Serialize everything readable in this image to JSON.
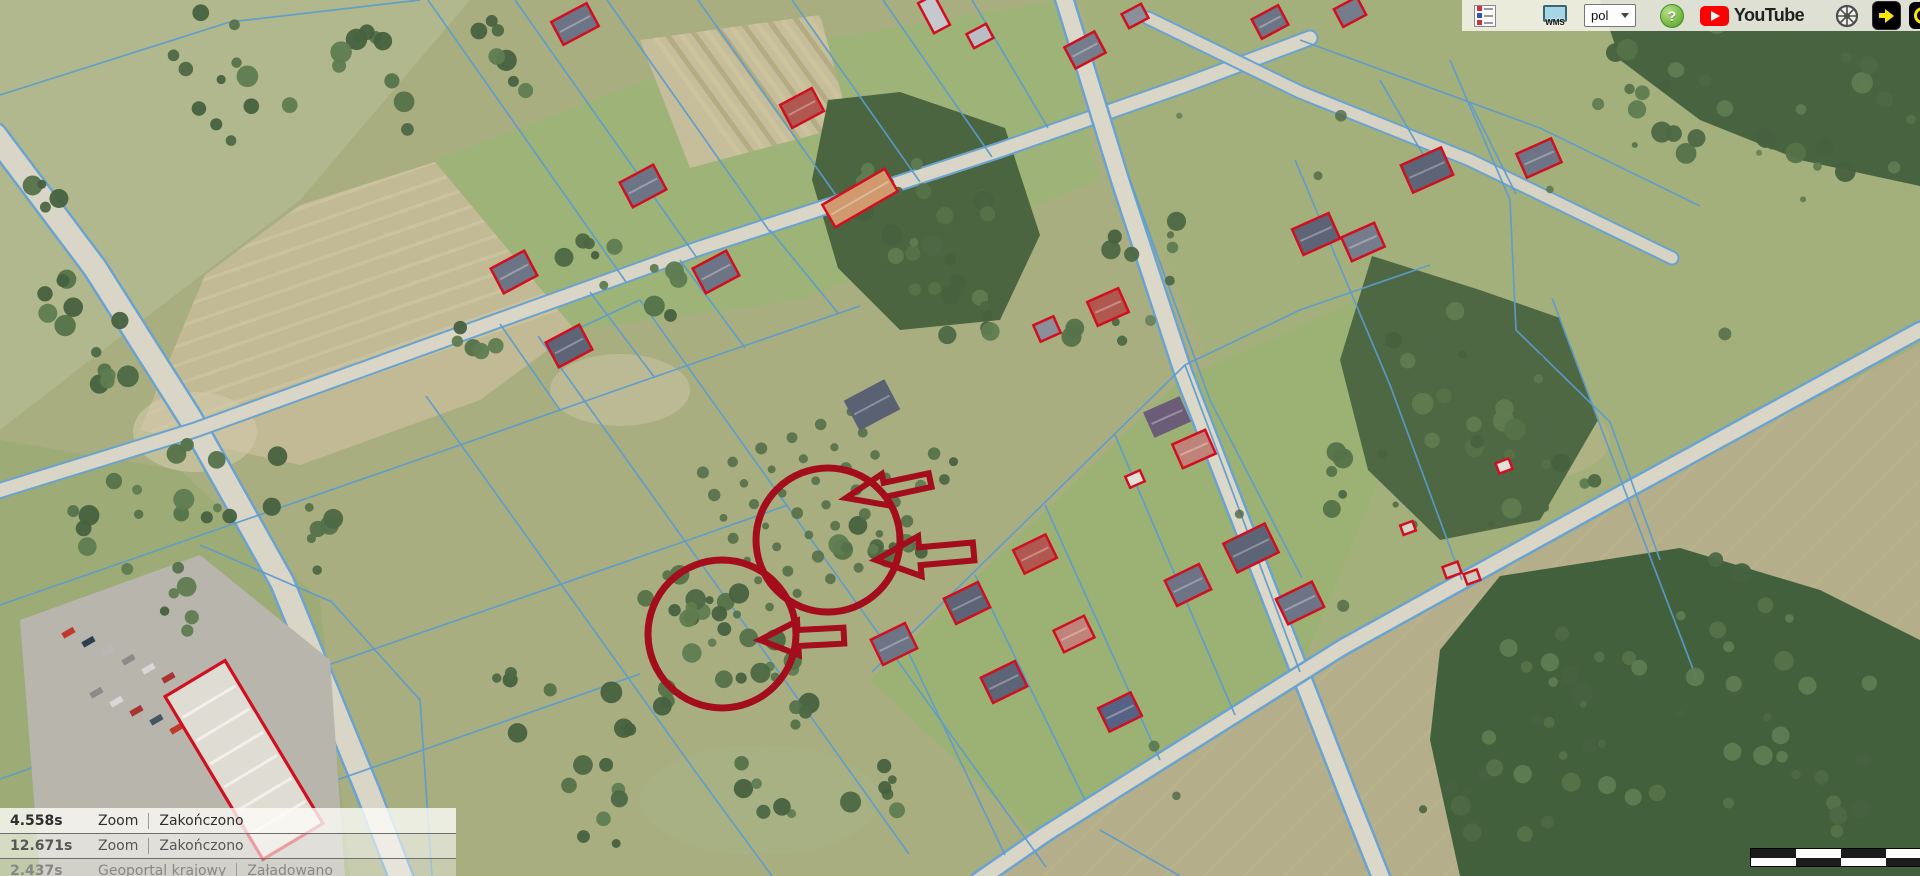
{
  "app": {
    "type": "aerial-map-viewer",
    "language": "pol"
  },
  "toolbar": {
    "legend_button": {
      "icon": "layer-legend-icon"
    },
    "wms_button": {
      "label": "WMS"
    },
    "language_select": {
      "value": "pol"
    },
    "help_button": {
      "label": "?"
    },
    "youtube": {
      "label": "YouTube"
    },
    "compass_button": {
      "icon": "globe-wheel-icon"
    },
    "forward_button": {
      "icon": "yellow-arrow-right-icon"
    },
    "partial_button": {
      "icon": "yellow-ring-icon"
    }
  },
  "status_log": {
    "rows": [
      {
        "time": "4.558s",
        "source": "Zoom",
        "status": "Zakończono"
      },
      {
        "time": "12.671s",
        "source": "Zoom",
        "status": "Zakończono"
      },
      {
        "time": "2.437s",
        "source": "Geoportal krajowy",
        "status": "Załadowano"
      }
    ]
  },
  "scale_bar": {
    "dark": "#1c1c1c",
    "light": "#ffffff",
    "pattern": [
      [
        "dark",
        "light",
        "dark",
        "light"
      ],
      [
        "light",
        "dark",
        "light",
        "dark"
      ]
    ]
  },
  "map_overlay": {
    "parcel_line_color": "#5c9ccc",
    "building_outline_color": "#d01020",
    "annotation_color": "#a30d1c",
    "annotations": {
      "circles": [
        {
          "cx": 828,
          "cy": 540,
          "r": 72
        },
        {
          "cx": 722,
          "cy": 634,
          "r": 74
        }
      ],
      "arrows": [
        {
          "tip_x": 846,
          "tip_y": 498,
          "length": 86,
          "head_len": 40,
          "head_half": 16,
          "tail_half": 7,
          "angle": -12
        },
        {
          "tip_x": 876,
          "tip_y": 560,
          "length": 98,
          "head_len": 44,
          "head_half": 20,
          "tail_half": 9,
          "angle": -5
        },
        {
          "tip_x": 760,
          "tip_y": 640,
          "length": 84,
          "head_len": 38,
          "head_half": 17,
          "tail_half": 8,
          "angle": -3
        }
      ]
    }
  }
}
